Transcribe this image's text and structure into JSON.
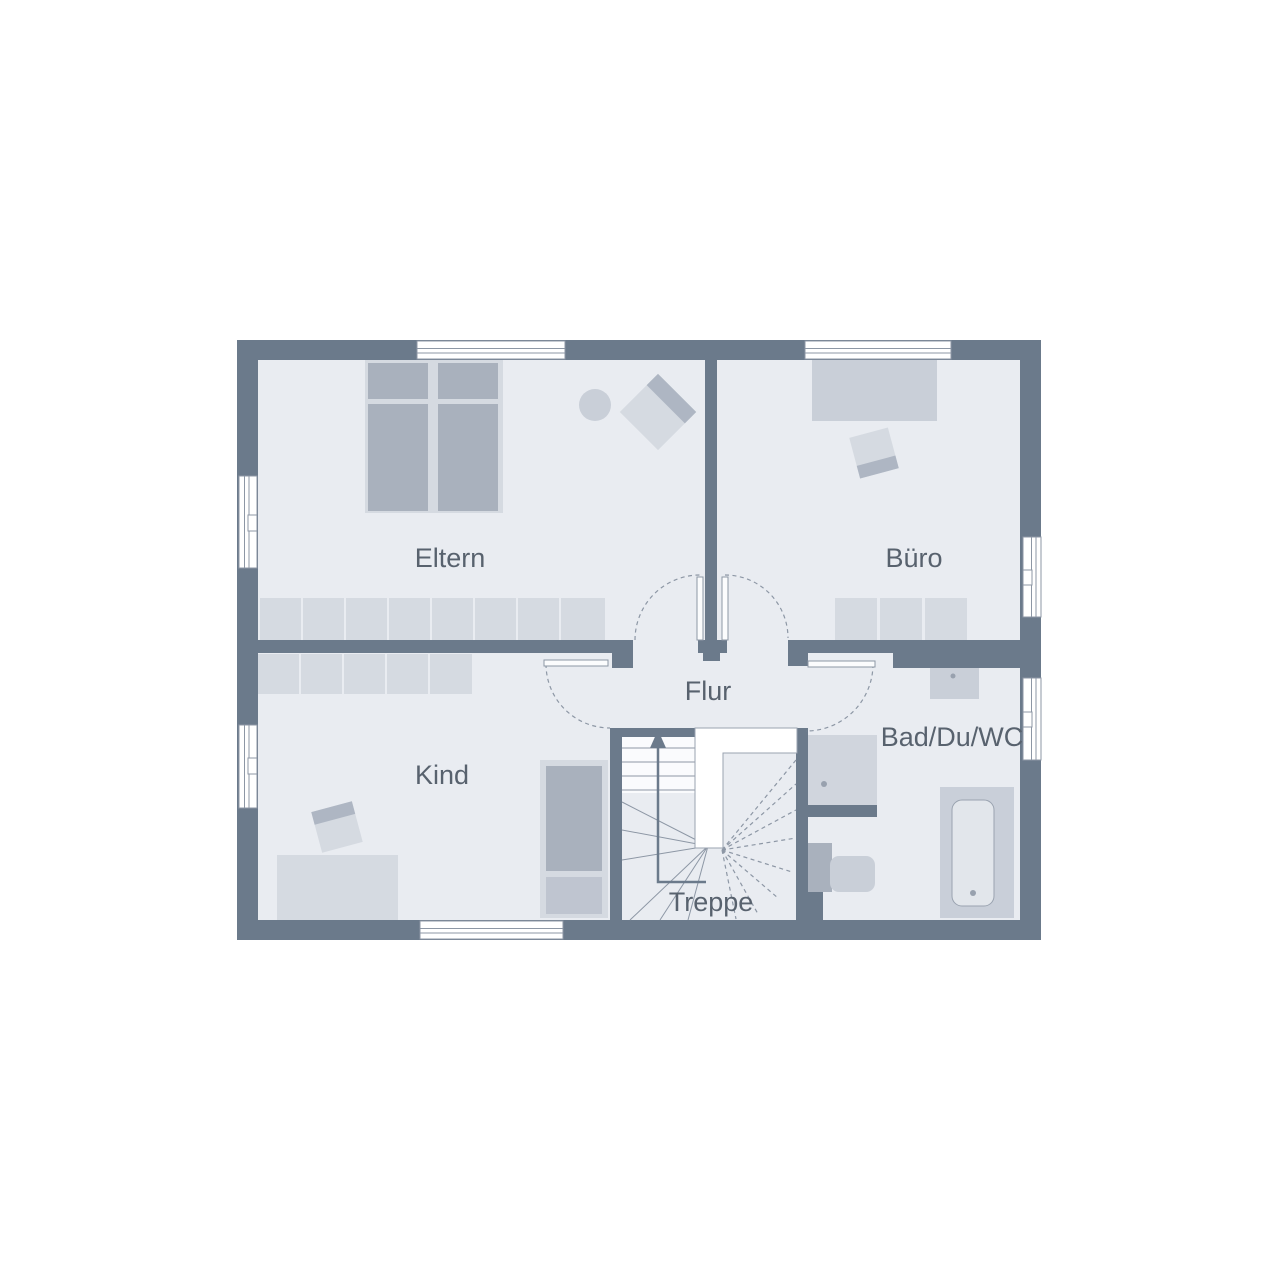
{
  "floorplan": {
    "rooms": {
      "eltern": {
        "label": "Eltern"
      },
      "buero": {
        "label": "Büro"
      },
      "kind": {
        "label": "Kind"
      },
      "flur": {
        "label": "Flur"
      },
      "bad": {
        "label": "Bad/Du/WC"
      },
      "treppe": {
        "label": "Treppe"
      }
    },
    "palette": {
      "background": "#ffffff",
      "wall": "#6b7a8b",
      "floor": "#e9ecf1",
      "furniture_light": "#d5dae1",
      "furniture_medium": "#c9cfd8",
      "furniture_dark": "#a9b1bd",
      "outline": "#8d97a5",
      "label_text": "#58626e"
    }
  }
}
